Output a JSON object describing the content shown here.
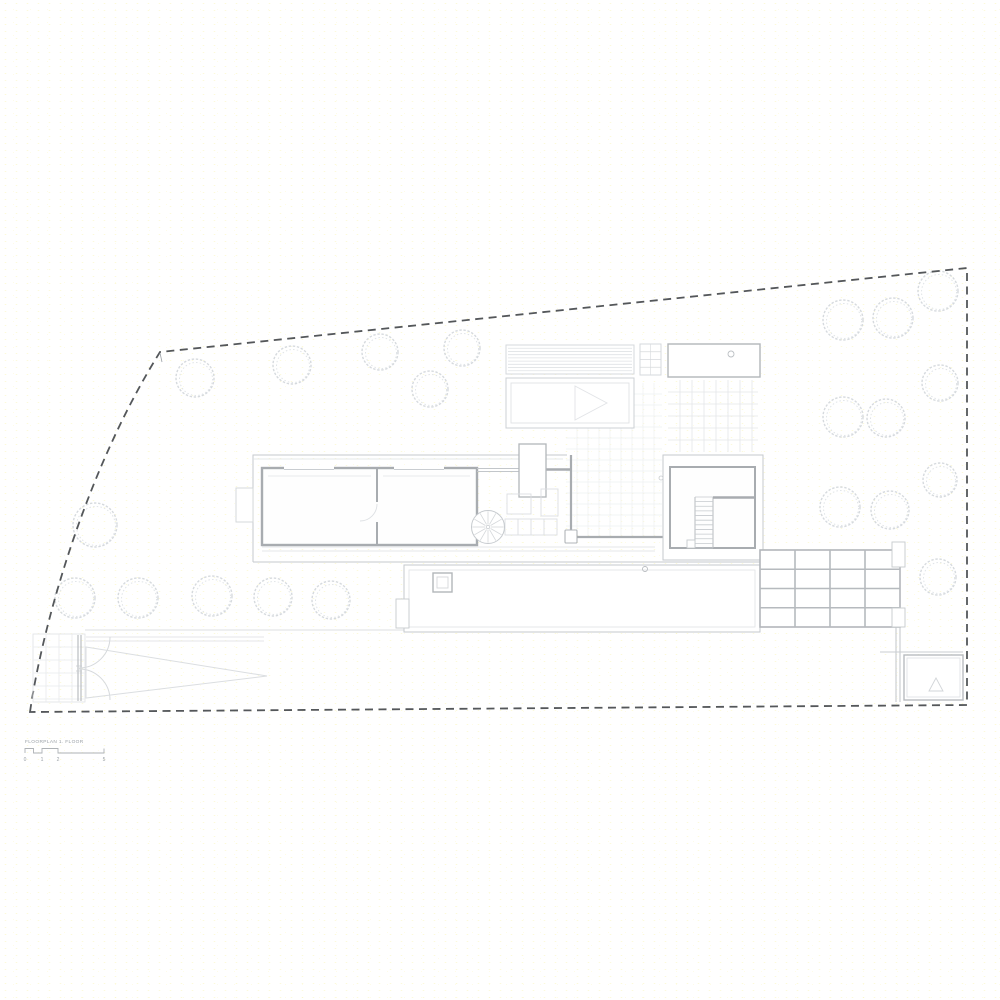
{
  "document": {
    "kind": "architectural floor plan drawing",
    "title_block": {
      "label": "FLOORPLAN 1. FLOOR",
      "scale_labels": [
        "0",
        "1",
        "2",
        "5"
      ]
    }
  },
  "colors": {
    "background": "#ffffff",
    "speckle": "#f6f0a6",
    "boundary_dash": "#54575a",
    "wall_dark": "#a8acb0",
    "line_medium": "#c6cace",
    "line_light": "#dcdfe2",
    "line_faint": "#eceef0",
    "tree_stroke": "#d6dade",
    "tree_stroke_inner": "#e0e4e7",
    "label_text": "#9aa0a6"
  },
  "site": {
    "boundary": {
      "style": "dashed",
      "corners": [
        [
          30,
          712
        ],
        [
          160,
          352
        ],
        [
          967,
          268
        ],
        [
          967,
          705
        ]
      ]
    },
    "trees": [
      [
        195,
        378,
        19
      ],
      [
        292,
        365,
        19
      ],
      [
        380,
        352,
        18
      ],
      [
        462,
        348,
        18
      ],
      [
        430,
        389,
        18
      ],
      [
        95,
        525,
        22
      ],
      [
        75,
        598,
        20
      ],
      [
        138,
        598,
        20
      ],
      [
        212,
        596,
        20
      ],
      [
        273,
        597,
        19
      ],
      [
        331,
        600,
        19
      ],
      [
        843,
        320,
        20
      ],
      [
        893,
        318,
        20
      ],
      [
        938,
        291,
        20
      ],
      [
        940,
        383,
        18
      ],
      [
        843,
        417,
        20
      ],
      [
        886,
        418,
        19
      ],
      [
        940,
        480,
        17
      ],
      [
        840,
        507,
        20
      ],
      [
        890,
        510,
        19
      ],
      [
        938,
        577,
        18
      ]
    ]
  },
  "plan": {
    "grids": [
      {
        "name": "drive-tile-grid",
        "x": 33,
        "y": 634,
        "w": 52,
        "h": 68,
        "cell": 13,
        "color": "#e8eaec",
        "sw": 0.8,
        "border": "#e0e2e5"
      },
      {
        "name": "courtyard-tile-grid",
        "x": 566,
        "y": 383,
        "w": 96,
        "h": 153,
        "cell": 11,
        "color": "#eef0f2",
        "sw": 0.7
      },
      {
        "name": "patio-tile-grid",
        "x": 668,
        "y": 380,
        "w": 90,
        "h": 72,
        "cell": 12,
        "color": "#e4e6e9",
        "sw": 0.8
      },
      {
        "name": "pergola-beam-grid",
        "x": 760,
        "y": 550,
        "w": 140,
        "h": 77,
        "cols": 4,
        "rows": 4,
        "color": "#b6babe",
        "sw": 1.6,
        "fill": "#ffffff",
        "border": "#b2b6ba"
      }
    ],
    "louvers": {
      "name": "pool-deck-louver-lines",
      "x": 506,
      "y": 345,
      "w": 128,
      "h": 29,
      "lines": 8,
      "color": "#dfe2e5"
    },
    "stairs": [
      {
        "name": "interior-stair-treads",
        "x": 695,
        "y": 497,
        "w": 18,
        "h": 51,
        "treads": 11,
        "color": "#c6cace"
      },
      {
        "name": "pool-step-treads",
        "x": 640,
        "y": 344,
        "w": 21,
        "h": 31,
        "treads": 4,
        "color": "#d6d9dc"
      }
    ],
    "spiral_stair": {
      "cx": 488,
      "cy": 527,
      "r": 16.5,
      "spokes": 12,
      "color": "#d4d7da"
    }
  }
}
